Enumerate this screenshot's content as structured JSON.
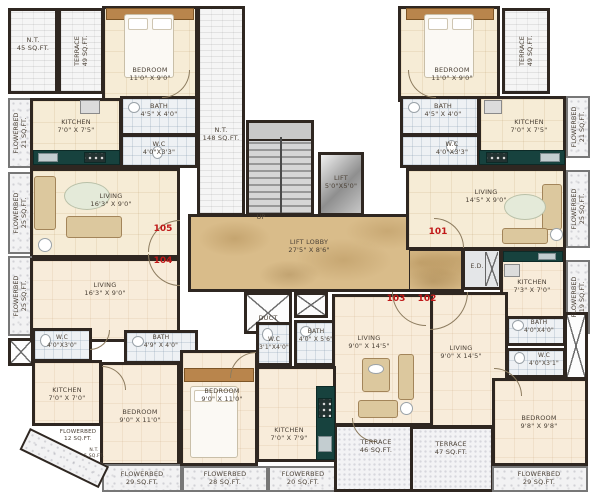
{
  "meta": {
    "type": "apartment-floor-plan"
  },
  "numbers": {
    "n101": "101",
    "n102": "102",
    "n103": "103",
    "n104": "104",
    "n105": "105"
  },
  "common": {
    "nt45": {
      "name": "N.T.",
      "area": "45 SQ.FT."
    },
    "nt148": {
      "name": "N.T.",
      "area": "148 SQ.FT."
    },
    "nt5": {
      "name": "N.T.",
      "area": "5 SQ.FT."
    },
    "up": "UP",
    "duct": "DUCT",
    "ed": "E.D.",
    "lift": {
      "name": "LIFT",
      "dims": "5'0\"X5'0\""
    },
    "lobby": {
      "name": "LIFT LOBBY",
      "dims": "27'5\" X 8'6\""
    },
    "terrace49_left": {
      "name": "TERRACE",
      "area": "49 SQ.FT."
    },
    "terrace49_right": {
      "name": "TERRACE",
      "area": "49 SQ.FT."
    },
    "terrace46": {
      "name": "TERRACE",
      "area": "46 SQ.FT."
    },
    "terrace47": {
      "name": "TERRACE",
      "area": "47 SQ.FT."
    },
    "fb21_left": {
      "name": "FLOWERBED",
      "area": "21 SQ.FT."
    },
    "fb25_left_upper": {
      "name": "FLOWERBED",
      "area": "25 SQ.FT."
    },
    "fb25_left_lower": {
      "name": "FLOWERBED",
      "area": "25 SQ.FT."
    },
    "fb12_left": {
      "name": "FLOWERBED",
      "area": "12 SQ.FT."
    },
    "fb29_bl": {
      "name": "FLOWERBED",
      "area": "29 SQ.FT."
    },
    "fb28_bottom": {
      "name": "FLOWERBED",
      "area": "28 SQ.FT."
    },
    "fb20_bottom": {
      "name": "FLOWERBED",
      "area": "20 SQ.FT."
    },
    "fb29_br": {
      "name": "FLOWERBED",
      "area": "29 SQ.FT."
    },
    "fb21_right": {
      "name": "FLOWERBED",
      "area": "21 SQ.FT."
    },
    "fb25_right": {
      "name": "FLOWERBED",
      "area": "25 SQ.FT."
    },
    "fb19_right": {
      "name": "FLOWERBED",
      "area": "19 SQ.FT."
    }
  },
  "units": {
    "u105": {
      "living": {
        "name": "LIVING",
        "dims": "16'3\" X 9'0\""
      },
      "bedroom": {
        "name": "BEDROOM",
        "dims": "11'0\" X 9'0\""
      },
      "kitchen": {
        "name": "KITCHEN",
        "dims": "7'0\" X 7'5\""
      },
      "bath": {
        "name": "BATH",
        "dims": "4'5\" X 4'0\""
      },
      "wc": {
        "name": "W.C",
        "dims": "4'0\"X3'3\""
      }
    },
    "u104": {
      "living": {
        "name": "LIVING",
        "dims": "16'3\" X 9'0\""
      },
      "bedroom": {
        "name": "BEDROOM",
        "dims": "9'0\" X 11'0\""
      },
      "kitchen": {
        "name": "KITCHEN",
        "dims": "7'0\" X 7'0\""
      },
      "bath": {
        "name": "BATH",
        "dims": "4'9\" X 4'0\""
      },
      "wc": {
        "name": "W.C",
        "dims": "4'0\"X3'0\""
      }
    },
    "u103": {
      "living": {
        "name": "LIVING",
        "dims": "9'0\" X 14'5\""
      },
      "bedroom": {
        "name": "BEDROOM",
        "dims": "9'0\" X 11'0\""
      },
      "kitchen": {
        "name": "KITCHEN",
        "dims": "7'0\" X 7'9\""
      },
      "bath": {
        "name": "BATH",
        "dims": "4'0\" X 5'6\""
      },
      "wc": {
        "name": "W.C",
        "dims": "3'1\"X4'0\""
      }
    },
    "u102": {
      "living": {
        "name": "LIVING",
        "dims": "9'0\" X 14'5\""
      },
      "bedroom": {
        "name": "BEDROOM",
        "dims": "9'8\" X 9'8\""
      },
      "kitchen": {
        "name": "KITCHEN",
        "dims": "7'3\" X 7'0\""
      },
      "bath": {
        "name": "BATH",
        "dims": "4'0\"X4'0\""
      },
      "wc": {
        "name": "W.C",
        "dims": "4'0\"X3'1\""
      }
    },
    "u101": {
      "living": {
        "name": "LIVING",
        "dims": "14'5\" X 9'0\""
      },
      "bedroom": {
        "name": "BEDROOM",
        "dims": "11'0\" X 9'0\""
      },
      "kitchen": {
        "name": "KITCHEN",
        "dims": "7'0\" X 7'5\""
      },
      "bath": {
        "name": "BATH",
        "dims": "4'5\" X 4'0\""
      },
      "wc": {
        "name": "W.C",
        "dims": "4'0\"X3'3\""
      }
    }
  },
  "colors": {
    "wall": "#2f2721",
    "floor_cream": "#f6ecd6",
    "marble": "#d9bc8a",
    "counter": "#17423e",
    "unit_number_red": "#c01818"
  }
}
